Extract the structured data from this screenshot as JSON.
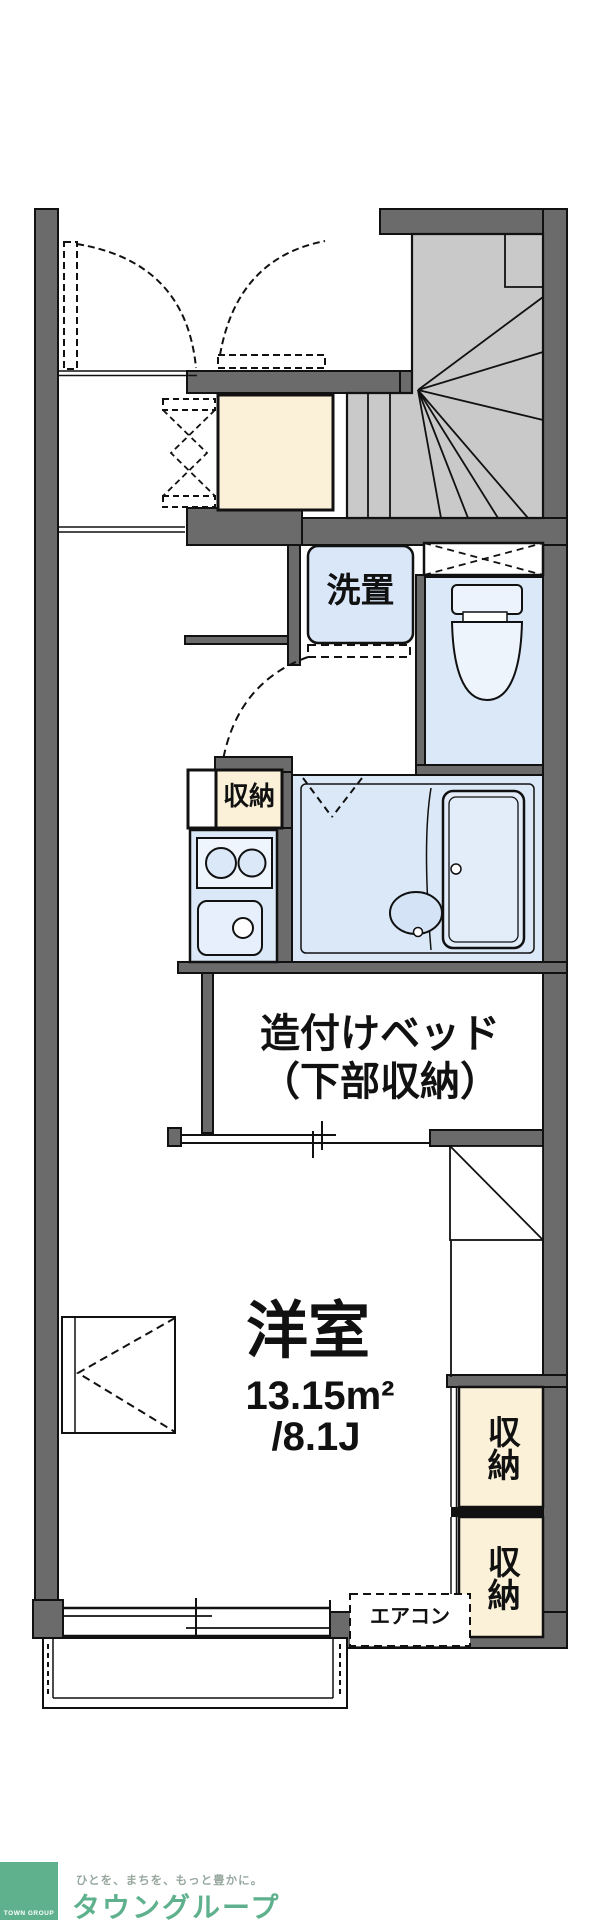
{
  "plan": {
    "labels": {
      "laundry": "洗置",
      "closet_mid": "収納",
      "bed_line1": "造付けベッド",
      "bed_line2": "（下部収納）",
      "room_name": "洋室",
      "room_area_m2": "13.15m²",
      "room_area_jo": "/8.1J",
      "aircon": "エアコン",
      "closet_right_top": "収納",
      "closet_right_bottom": "収納"
    },
    "colors": {
      "wall": "#6b6b6b",
      "outline": "#111111",
      "stairs": "#c9c9c9",
      "fixture_blue": "#dbe8f8",
      "fixture_blue_light": "#eef4fc",
      "closet_beige": "#fbf1d8"
    }
  },
  "footer": {
    "logo_text": "TOWN GROUP",
    "tagline": "ひとを、まちを、もっと豊かに。",
    "brand": "タウングループ",
    "brand_color": "#5fb18d"
  }
}
